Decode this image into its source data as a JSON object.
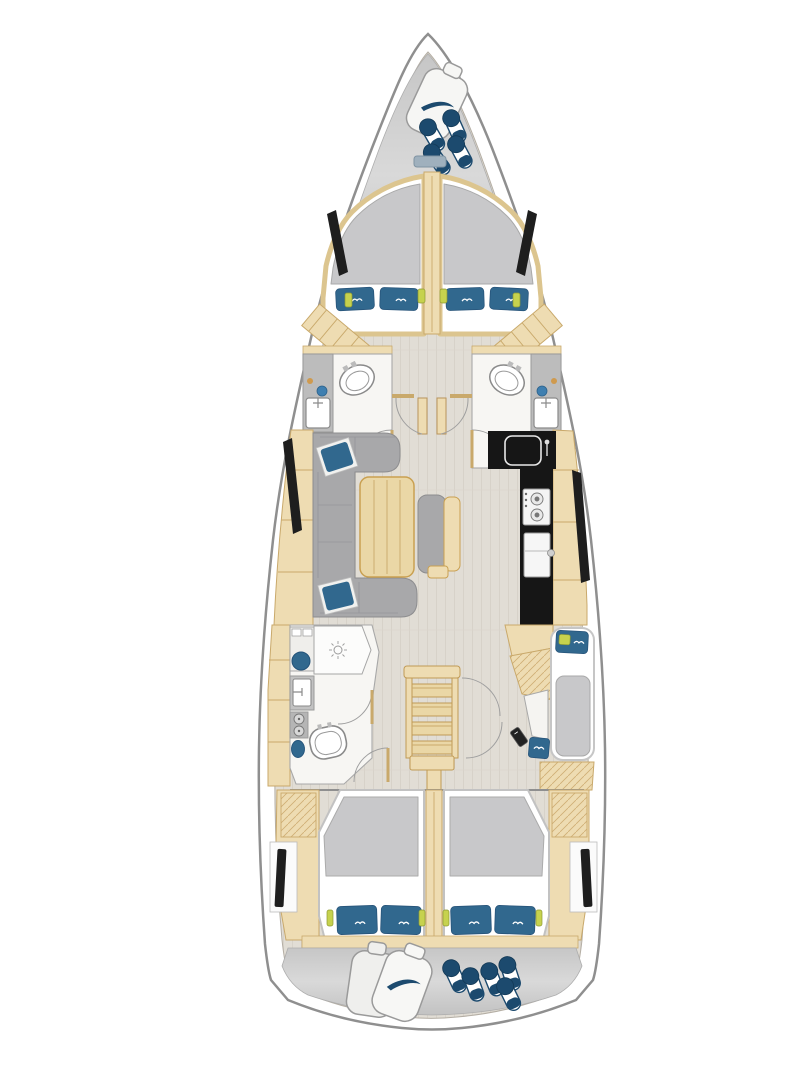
{
  "diagram": {
    "kind": "sailing-yacht-interior-floor-plan",
    "orientation": "bow-up",
    "palette": {
      "background": "#ffffff",
      "hull_white": "#ffffff",
      "hull_stroke": "#8f8f8f",
      "floor": "#e1ddd5",
      "floor_grain": "#d7d2c9",
      "locker_gray_light": "#dedede",
      "locker_gray_dark": "#c0c0c0",
      "wood": "#eedcb2",
      "wood_line": "#c9a96b",
      "wood_dark": "#c09a55",
      "mattress_gray": "#c8c8ca",
      "sofa_gray": "#a8a8aa",
      "pillow_blue": "#31688e",
      "fender_navy": "#1c4a6e",
      "fixture_blue": "#3f7fb0",
      "accent_green": "#c6d24e",
      "appliance_black": "#161616",
      "window_black": "#1e1e1e",
      "room_white": "#f7f6f3",
      "fixture_white": "#ffffff",
      "bench_wood": "#ead7a6",
      "soap_orange": "#cf9a4e"
    },
    "inventory": {
      "double_berths_forward": 2,
      "double_berths_aft": 2,
      "single_berths": 1,
      "heads_forward": 2,
      "heads_aft": 1,
      "toilets": 3,
      "showers": 1,
      "salon_sofas": 1,
      "salon_tables": 1,
      "bench_seats": 1,
      "galley_sinks": 1,
      "stove_burners": 2,
      "companionway_steps": 4,
      "bow_round_fenders": 4,
      "stern_round_fenders": 5,
      "bow_bottle_fenders": 1,
      "stern_bottle_fenders": 2,
      "pillows_blue": 10
    },
    "regions": [
      "bow-anchor-locker",
      "forward-cabin-port",
      "forward-cabin-starboard",
      "head-forward-port",
      "head-forward-starboard",
      "corridor-double-doors",
      "salon-sofa",
      "salon-table",
      "bench-seat",
      "galley",
      "head-aft-port",
      "companionway-stairs",
      "single-cabin-starboard",
      "aft-cabin-port",
      "aft-cabin-starboard",
      "stern-lazarette"
    ]
  }
}
